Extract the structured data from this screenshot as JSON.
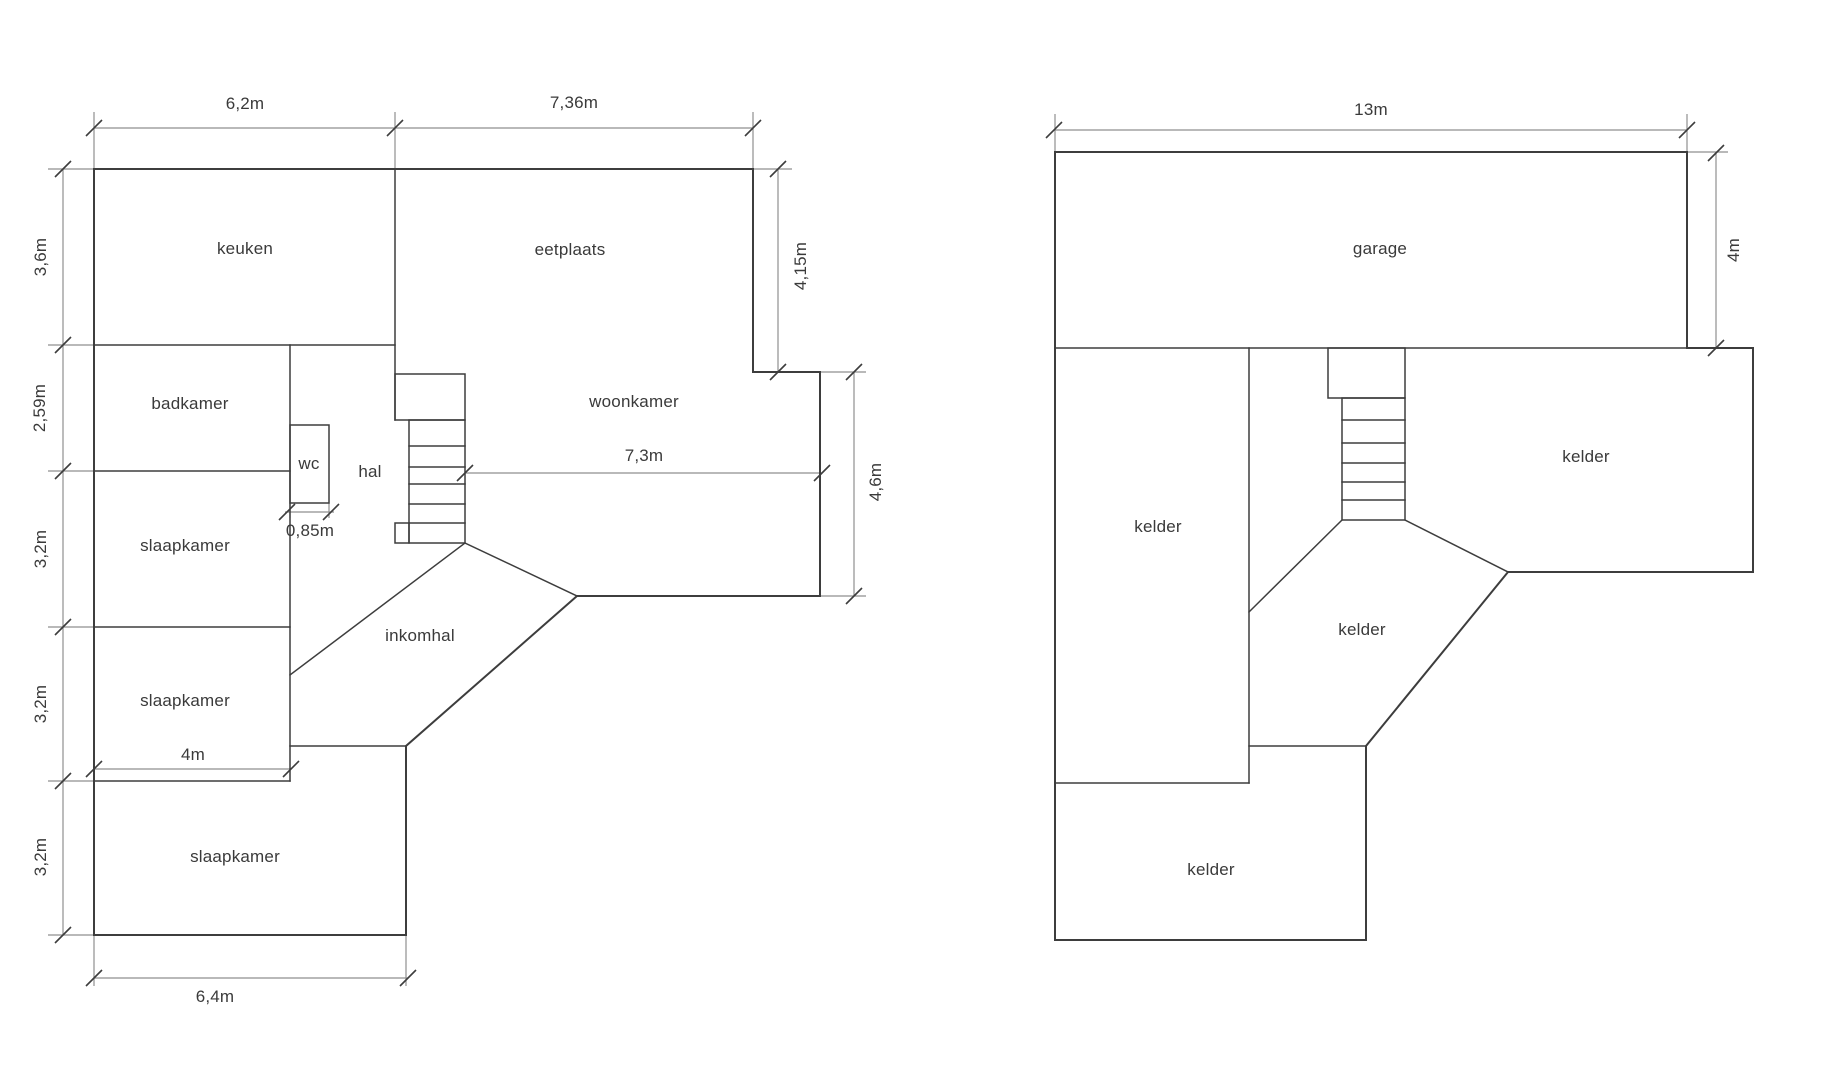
{
  "colors": {
    "wall": "#3d3d3d",
    "dimension_line": "#8f8f8f",
    "text": "#3a3a3a",
    "background": "#ffffff"
  },
  "ground_floor": {
    "rooms": [
      {
        "id": "keuken",
        "label": "keuken"
      },
      {
        "id": "eetplaats",
        "label": "eetplaats"
      },
      {
        "id": "badkamer",
        "label": "badkamer"
      },
      {
        "id": "wc",
        "label": "wc"
      },
      {
        "id": "hal",
        "label": "hal"
      },
      {
        "id": "woonkamer",
        "label": "woonkamer"
      },
      {
        "id": "slaapkamer-1",
        "label": "slaapkamer"
      },
      {
        "id": "inkomhal",
        "label": "inkomhal"
      },
      {
        "id": "slaapkamer-2",
        "label": "slaapkamer"
      },
      {
        "id": "slaapkamer-3",
        "label": "slaapkamer"
      }
    ],
    "dimensions": [
      {
        "id": "width-keuken",
        "label": "6,2m"
      },
      {
        "id": "width-eetplaats",
        "label": "7,36m"
      },
      {
        "id": "height-keuken",
        "label": "3,6m"
      },
      {
        "id": "height-badkamer",
        "label": "2,59m"
      },
      {
        "id": "height-slaapkamer-1",
        "label": "3,2m"
      },
      {
        "id": "height-slaapkamer-2",
        "label": "3,2m"
      },
      {
        "id": "height-slaapkamer-3",
        "label": "3,2m"
      },
      {
        "id": "height-eetplaats-right",
        "label": "4,15m"
      },
      {
        "id": "height-woonkamer-right",
        "label": "4,6m"
      },
      {
        "id": "width-woonkamer",
        "label": "7,3m"
      },
      {
        "id": "width-wc",
        "label": "0,85m"
      },
      {
        "id": "width-slaapkamer-2",
        "label": "4m"
      },
      {
        "id": "width-bottom",
        "label": "6,4m"
      }
    ]
  },
  "basement": {
    "rooms": [
      {
        "id": "garage",
        "label": "garage"
      },
      {
        "id": "kelder-left",
        "label": "kelder"
      },
      {
        "id": "kelder-right",
        "label": "kelder"
      },
      {
        "id": "kelder-middle",
        "label": "kelder"
      },
      {
        "id": "kelder-bottom",
        "label": "kelder"
      }
    ],
    "dimensions": [
      {
        "id": "width-garage",
        "label": "13m"
      },
      {
        "id": "height-garage",
        "label": "4m"
      }
    ]
  }
}
